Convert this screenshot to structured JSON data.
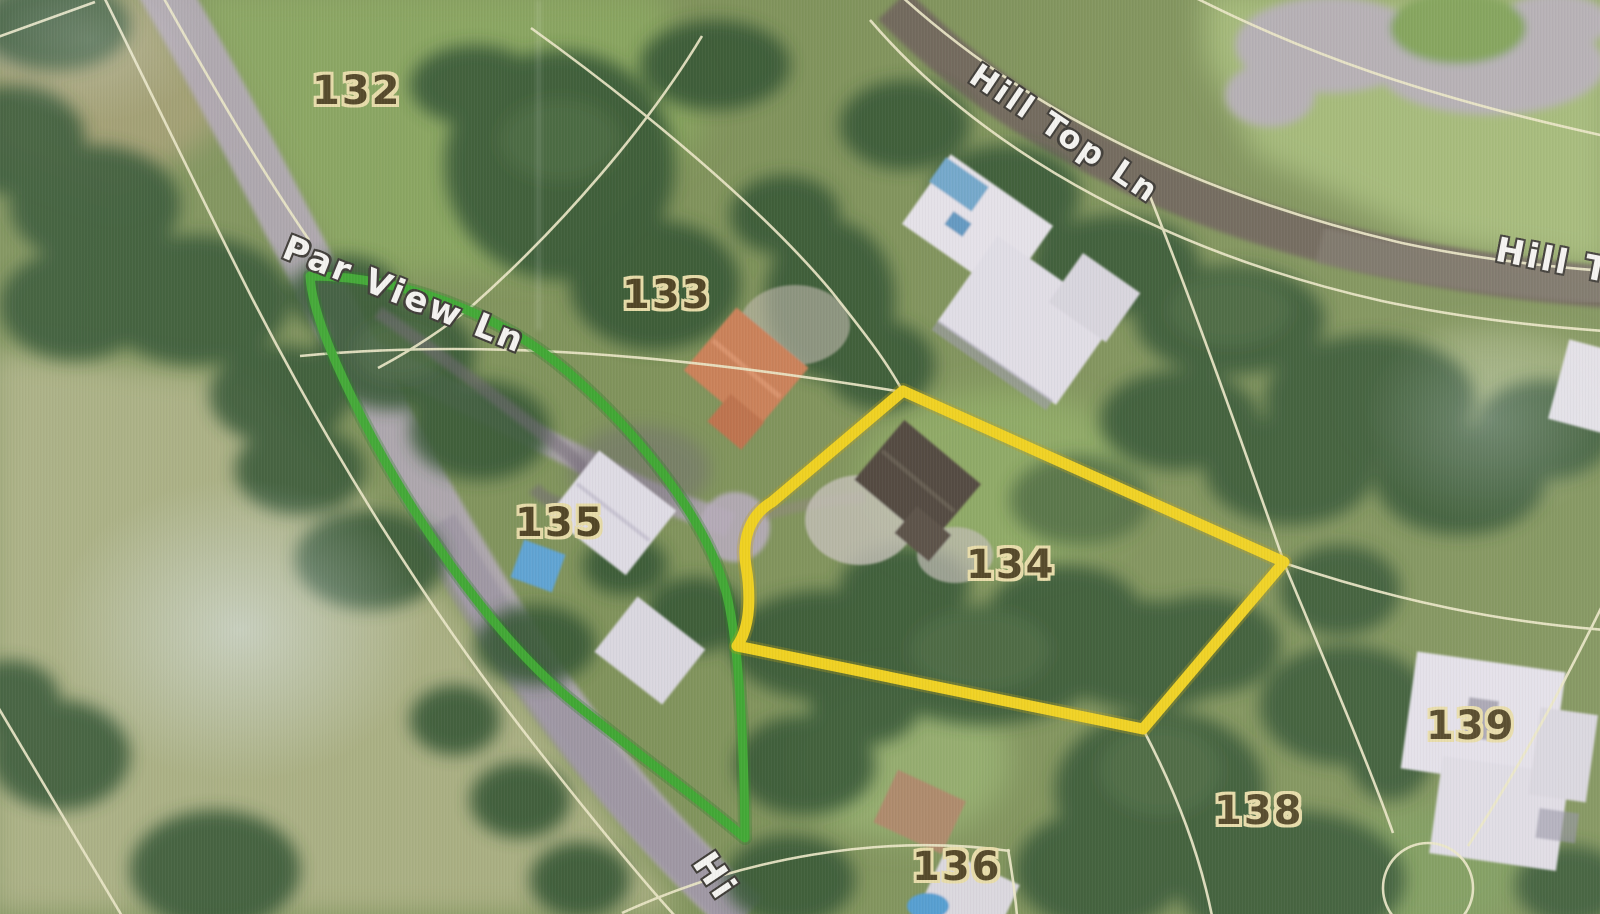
{
  "map": {
    "description": "Aerial parcel map with highlighted lots",
    "parcel_labels": {
      "p132": "132",
      "p133": "133",
      "p134": "134",
      "p135": "135",
      "p136": "136",
      "p138": "138",
      "p139": "139"
    },
    "road_labels": {
      "par_view": "Par View Ln",
      "hill_top": "Hill Top Ln",
      "hill_top_right": "Hill T",
      "bottom_road": "Hi"
    },
    "highlight_colors": {
      "parcel_135": "#3ba62c",
      "parcel_134": "#f2d116"
    }
  }
}
